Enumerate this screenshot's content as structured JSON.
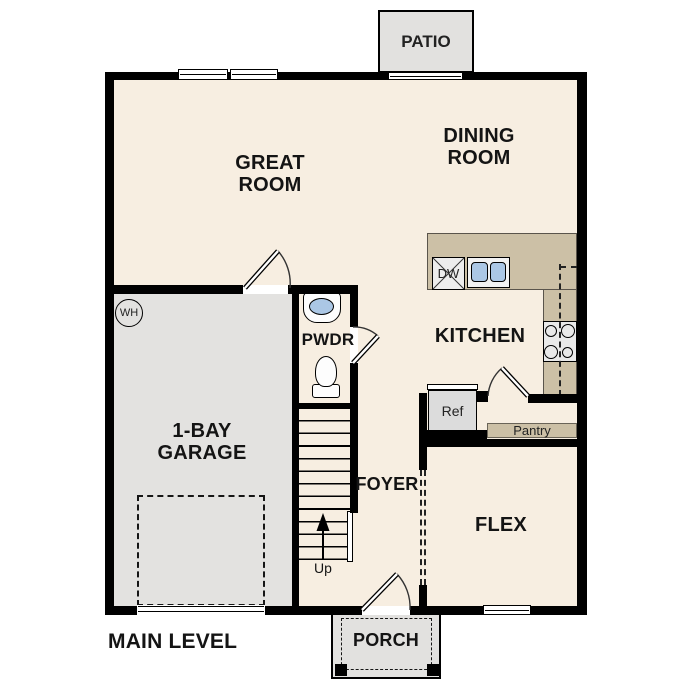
{
  "plan": {
    "title": "MAIN LEVEL",
    "rooms": {
      "great_room": "GREAT ROOM",
      "dining_room": "DINING ROOM",
      "kitchen": "KITCHEN",
      "garage": "1-BAY GARAGE",
      "foyer": "FOYER",
      "flex": "FLEX",
      "powder": "PWDR",
      "patio": "PATIO",
      "porch": "PORCH"
    },
    "fixtures": {
      "dishwasher": "DW",
      "refrigerator": "Ref",
      "pantry": "Pantry",
      "water_heater": "WH",
      "stairs_direction": "Up"
    },
    "colors": {
      "floor": "#f7eee1",
      "garage_floor": "#e3e2e0",
      "outdoor": "#e2e1df",
      "counter": "#ccc0a6",
      "sink_basin": "#abc7e5",
      "wall": "#000000"
    }
  }
}
